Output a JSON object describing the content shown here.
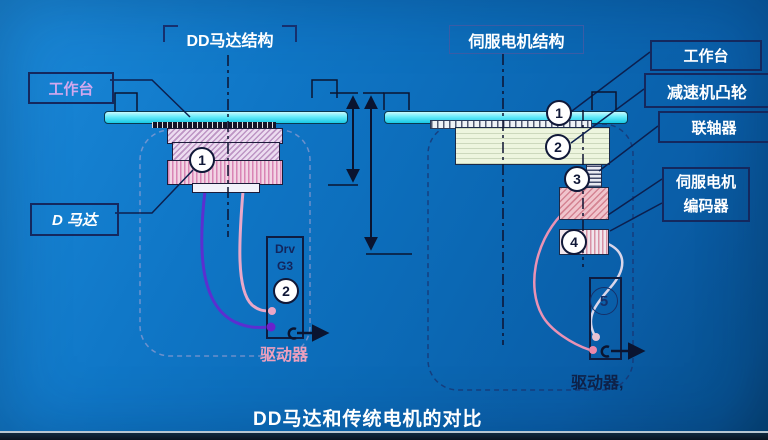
{
  "left_diagram": {
    "title": "DD马达结构",
    "worktable_label": "工作台",
    "motor_label": "D 马达",
    "driver_unit": {
      "line1": "Drv",
      "line2": "G3"
    },
    "driver_label": "驱动器",
    "markers": {
      "m1": "1",
      "m2": "2"
    }
  },
  "right_diagram": {
    "title": "伺服电机结构",
    "labels": {
      "worktable": "工作台",
      "reducer_cam": "减速机凸轮",
      "coupling": "联轴器",
      "servo_motor": "伺服电机",
      "encoder": "编码器"
    },
    "driver_label": "驱动器,",
    "markers": {
      "m1": "1",
      "m2": "2",
      "m3": "3",
      "m4": "4",
      "m5": "5"
    }
  },
  "footer": {
    "title": "DD马达和传统电机的对比"
  },
  "colors": {
    "background_blue": "#0e74c4",
    "worktable_cyan": "#3ddcf2",
    "label_violet": "#d2a8ee",
    "driver_label_pink": "#eda0be",
    "cable_purple": "#5b2fd0",
    "cable_pink": "#ea92b4",
    "outline_navy": "#14285e"
  }
}
